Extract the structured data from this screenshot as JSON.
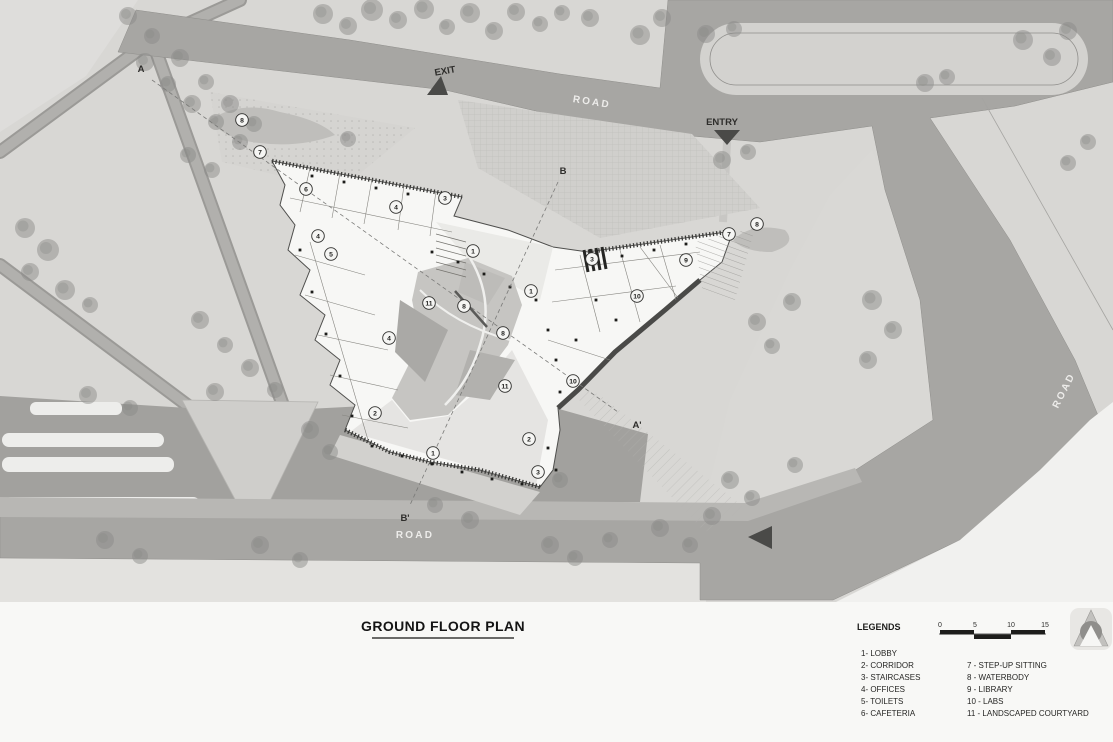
{
  "page": {
    "type": "architectural ground floor site plan"
  },
  "title": {
    "text": "GROUND FLOOR PLAN"
  },
  "plan_labels": {
    "exit": "EXIT",
    "entry": "ENTRY",
    "road_top": "ROAD",
    "road_bottom": "ROAD",
    "road_right": "ROAD",
    "section_a": "A",
    "section_b": "B",
    "section_a_prime": "A'",
    "section_b_prime": "B'"
  },
  "legend": {
    "heading": "LEGENDS",
    "column1": [
      "1- LOBBY",
      "2- CORRIDOR",
      "3- STAIRCASES",
      "4- OFFICES",
      "5- TOILETS",
      "6- CAFETERIA"
    ],
    "column2": [
      "7 - STEP-UP SITTING",
      "8 - WATERBODY",
      "9 - LIBRARY",
      "10 - LABS",
      "11 - LANDSCAPED COURTYARD"
    ]
  },
  "scale_bar": {
    "ticks": [
      "0",
      "5",
      "10",
      "15"
    ]
  },
  "north_arrow": {
    "icon": "north-arrow"
  },
  "plan_markers": [
    {
      "n": "8",
      "x": 242,
      "y": 120
    },
    {
      "n": "7",
      "x": 260,
      "y": 152
    },
    {
      "n": "6",
      "x": 306,
      "y": 189
    },
    {
      "n": "4",
      "x": 396,
      "y": 207
    },
    {
      "n": "3",
      "x": 445,
      "y": 198
    },
    {
      "n": "4",
      "x": 318,
      "y": 236
    },
    {
      "n": "5",
      "x": 331,
      "y": 254
    },
    {
      "n": "1",
      "x": 473,
      "y": 251
    },
    {
      "n": "3",
      "x": 592,
      "y": 259
    },
    {
      "n": "7",
      "x": 729,
      "y": 234
    },
    {
      "n": "8",
      "x": 757,
      "y": 224
    },
    {
      "n": "9",
      "x": 686,
      "y": 260
    },
    {
      "n": "10",
      "x": 637,
      "y": 296
    },
    {
      "n": "1",
      "x": 531,
      "y": 291
    },
    {
      "n": "11",
      "x": 429,
      "y": 303
    },
    {
      "n": "8",
      "x": 464,
      "y": 306
    },
    {
      "n": "8",
      "x": 503,
      "y": 333
    },
    {
      "n": "4",
      "x": 389,
      "y": 338
    },
    {
      "n": "11",
      "x": 505,
      "y": 386
    },
    {
      "n": "10",
      "x": 573,
      "y": 381
    },
    {
      "n": "2",
      "x": 375,
      "y": 413
    },
    {
      "n": "1",
      "x": 433,
      "y": 453
    },
    {
      "n": "2",
      "x": 529,
      "y": 439
    },
    {
      "n": "3",
      "x": 538,
      "y": 472
    }
  ],
  "colors": {
    "ground": "#d8d7d4",
    "road": "#a7a6a3",
    "building": "#f7f7f5",
    "courtyard": "#c6c5c2",
    "annotation_bg": "#f8f8f6",
    "ink": "#2b2b2b",
    "road_text": "#edecea"
  }
}
